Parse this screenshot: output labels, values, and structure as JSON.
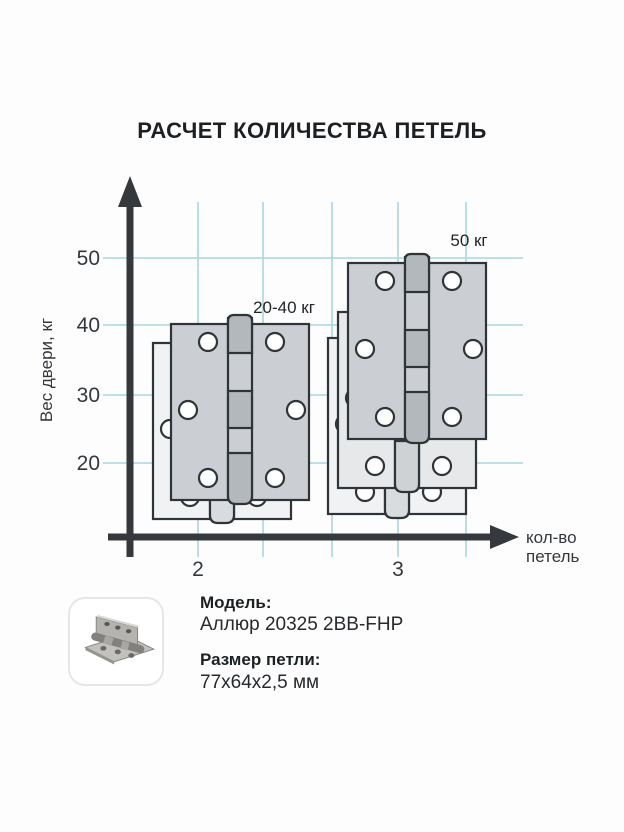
{
  "chart_data": {
    "type": "scatter",
    "title": "РАСЧЕТ КОЛИЧЕСТВА ПЕТЕЛЬ",
    "xlabel": "кол-во петель",
    "xlabel_lines": [
      "кол-во",
      "петель"
    ],
    "ylabel": "Вес двери, кг",
    "x_ticks": [
      "2",
      "3"
    ],
    "y_ticks": [
      "50",
      "40",
      "30",
      "20"
    ],
    "xlim": [
      2,
      3
    ],
    "ylim": [
      0,
      55
    ],
    "grid": true,
    "grid_color": "#a8d6e0",
    "points": [
      {
        "hinge_count": 2,
        "door_weight_label": "20-40 кг",
        "weight_min_kg": 20,
        "weight_max_kg": 40,
        "hinges_pictured": 2
      },
      {
        "hinge_count": 3,
        "door_weight_label": "50 кг",
        "weight_min_kg": 50,
        "weight_max_kg": 50,
        "hinges_pictured": 3
      }
    ]
  },
  "product": {
    "model_label": "Модель:",
    "model_value": "Аллюр 20325 2BB-FHP",
    "size_label": "Размер петли:",
    "size_value": "77х64х2,5 мм"
  },
  "colors": {
    "grid": "#a8d6e0",
    "axis": "#35393d",
    "hinge_front": "#cbcfd3",
    "hinge_middle": "#e6e8ea",
    "hinge_back": "#f1f2f3",
    "text": "#22262a"
  }
}
